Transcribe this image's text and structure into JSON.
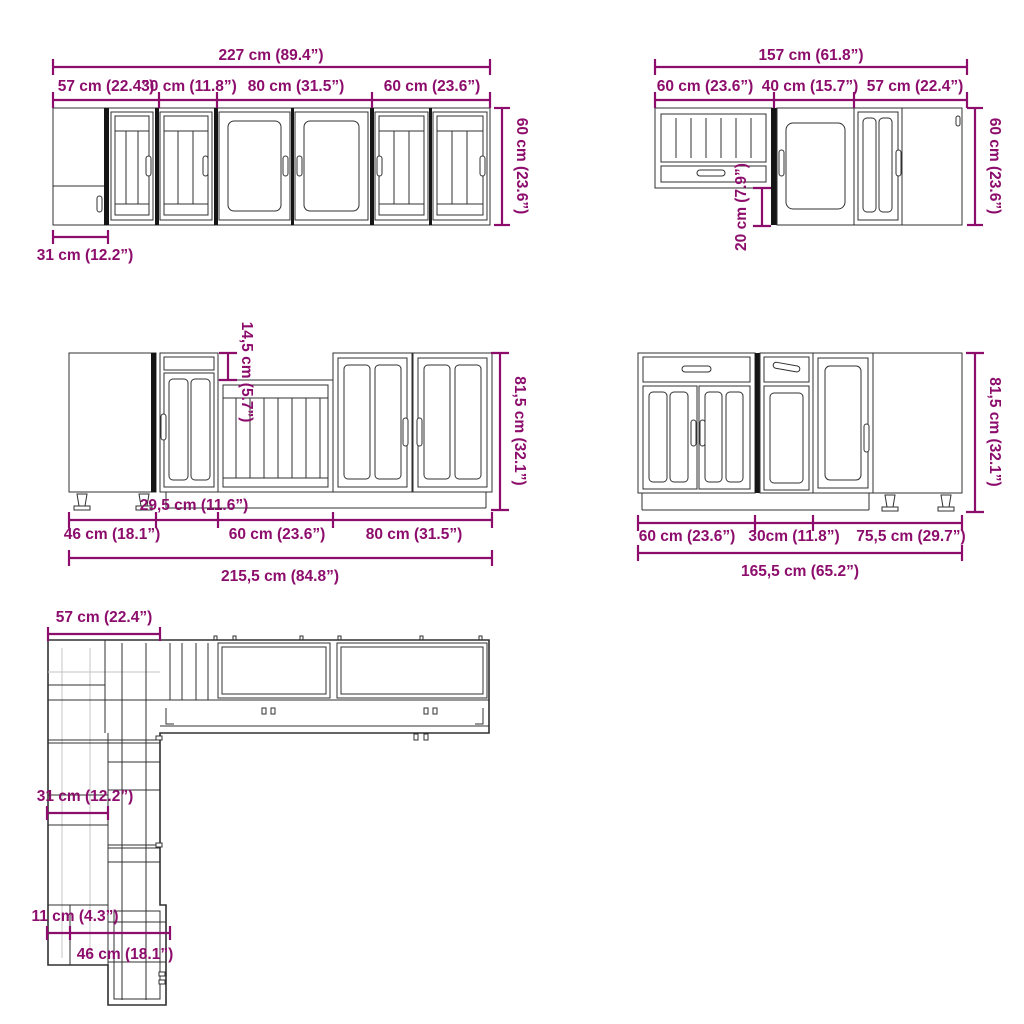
{
  "colors": {
    "dimension": "#8d0d6c",
    "line_art": "#303030",
    "background": "#ffffff"
  },
  "dims": {
    "wall_left": {
      "overall": "227 cm (89.4”)",
      "segments": [
        "57 cm (22.4”)",
        "30 cm (11.8”)",
        "80 cm (31.5”)",
        "60 cm (23.6”)"
      ],
      "height": "60 cm (23.6”)",
      "depth": "31 cm (12.2”)"
    },
    "wall_right": {
      "overall": "157 cm (61.8”)",
      "segments": [
        "60 cm (23.6”)",
        "40 cm (15.7”)",
        "57 cm (22.4”)"
      ],
      "height": "60 cm (23.6”)",
      "drop": "20 cm (7.9”)"
    },
    "base_left": {
      "overall": "215,5 cm (84.8”)",
      "segments": [
        "46 cm (18.1”)",
        "60 cm (23.6”)",
        "80 cm (31.5”)"
      ],
      "recess_width": "29,5 cm (11.6”)",
      "recess_drop": "14,5 cm (5.7”)",
      "height": "81,5 cm (32.1”)"
    },
    "base_right": {
      "overall": "165,5 cm (65.2”)",
      "segments": [
        "60 cm (23.6”)",
        "30cm (11.8”)",
        "75,5 cm (29.7”)"
      ],
      "height": "81,5 cm (32.1”)"
    },
    "plan": {
      "top_width": "57 cm (22.4”)",
      "left_depth": "31 cm (12.2”)",
      "filler_width": "11 cm (4.3”)",
      "bottom_width": "46 cm (18.1”)"
    }
  }
}
